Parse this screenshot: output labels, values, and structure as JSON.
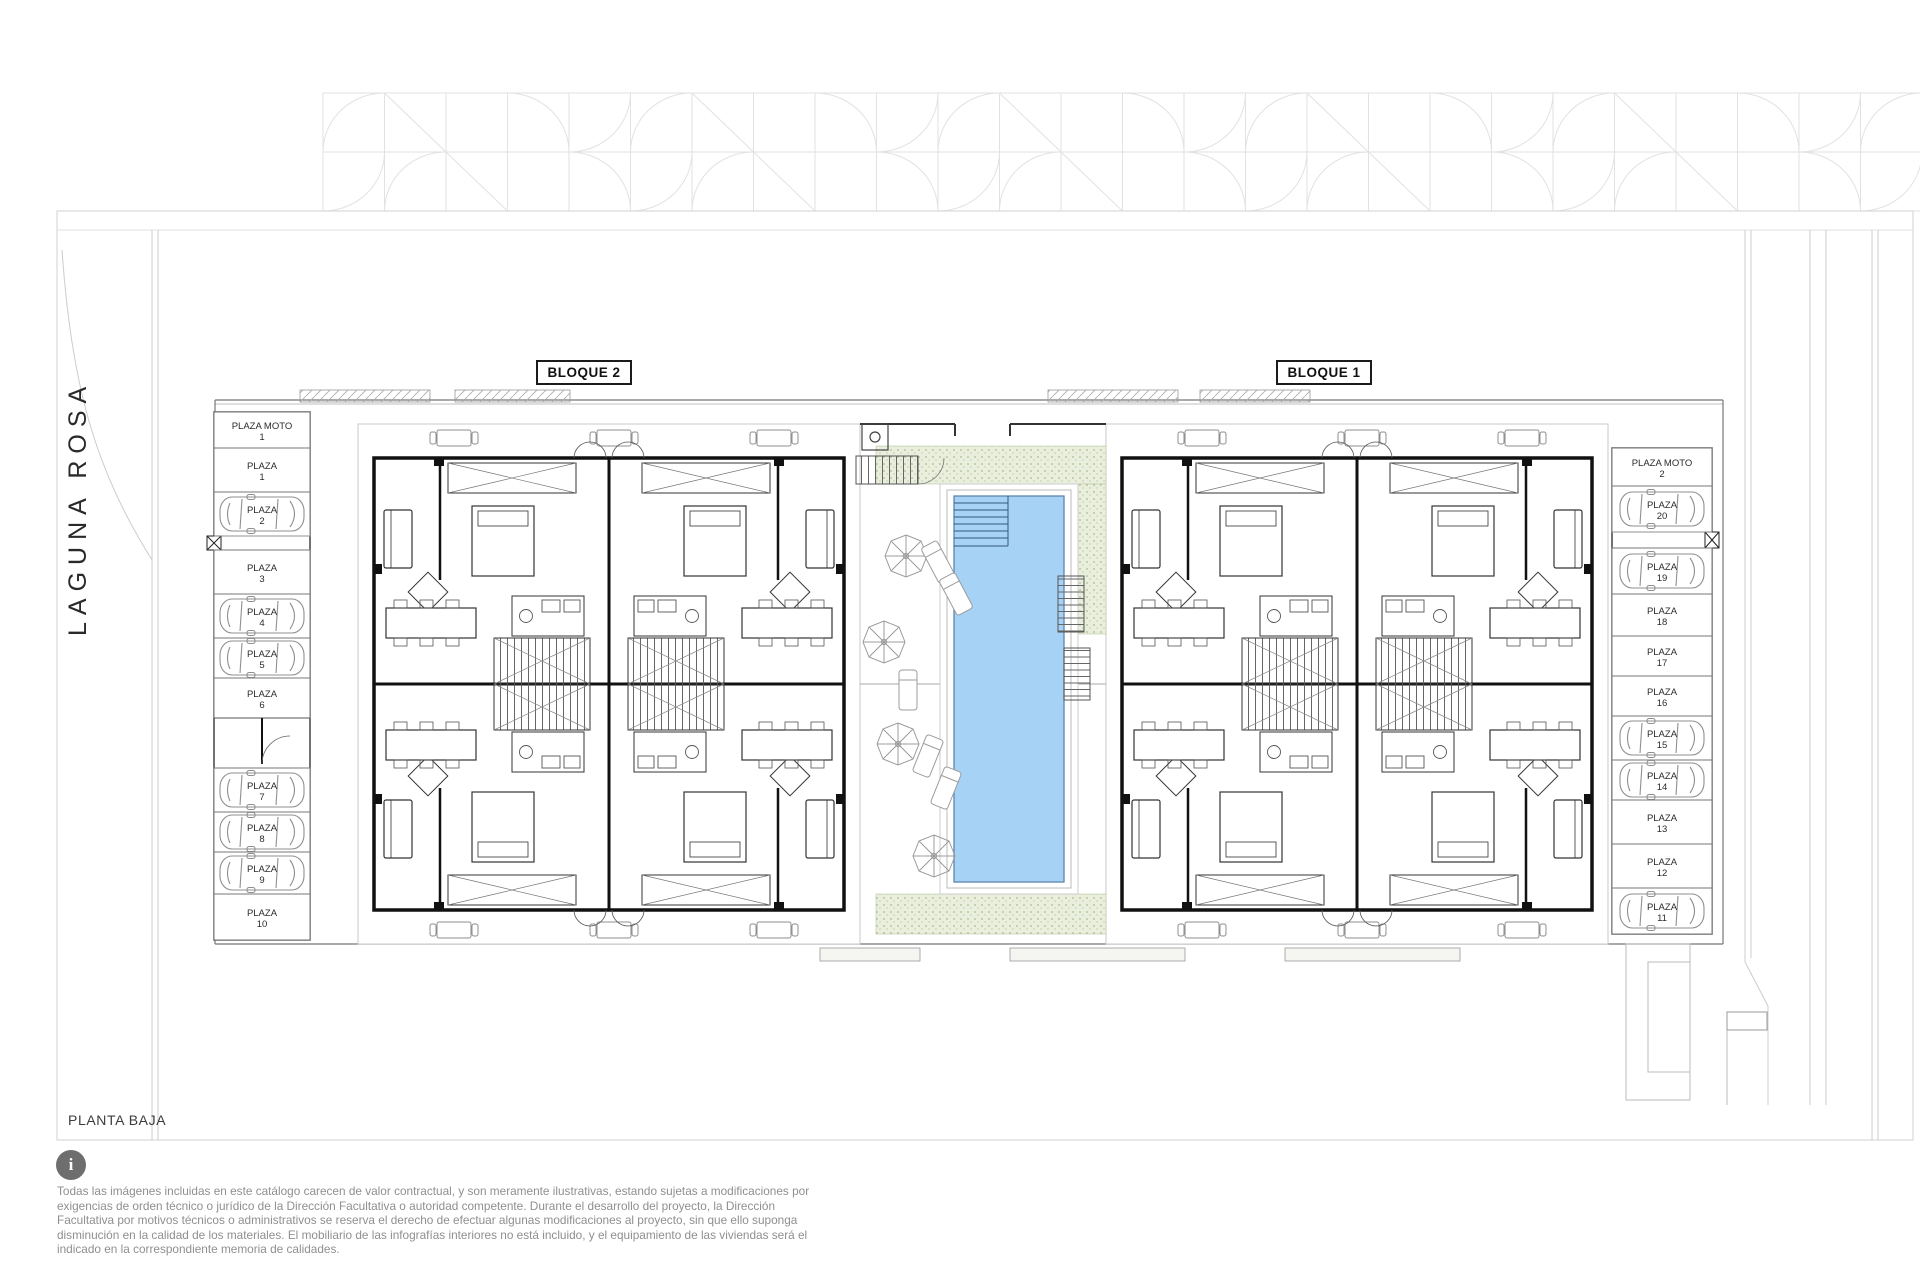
{
  "plan": {
    "title": "PLANTA BAJA",
    "street": "LAGUNA ROSA",
    "blocks": [
      {
        "label": "BLOQUE 2"
      },
      {
        "label": "BLOQUE 1"
      }
    ]
  },
  "parking": {
    "left": [
      {
        "name": "PLAZA MOTO",
        "number": "1",
        "occupied": false
      },
      {
        "name": "PLAZA",
        "number": "1",
        "occupied": false
      },
      {
        "name": "PLAZA",
        "number": "2",
        "occupied": true
      },
      {
        "name": "PLAZA",
        "number": "3",
        "occupied": false
      },
      {
        "name": "PLAZA",
        "number": "4",
        "occupied": true
      },
      {
        "name": "PLAZA",
        "number": "5",
        "occupied": true
      },
      {
        "name": "PLAZA",
        "number": "6",
        "occupied": false
      },
      {
        "name": "PLAZA",
        "number": "7",
        "occupied": true
      },
      {
        "name": "PLAZA",
        "number": "8",
        "occupied": true
      },
      {
        "name": "PLAZA",
        "number": "9",
        "occupied": true
      },
      {
        "name": "PLAZA",
        "number": "10",
        "occupied": false
      }
    ],
    "right": [
      {
        "name": "PLAZA MOTO",
        "number": "2",
        "occupied": false
      },
      {
        "name": "PLAZA",
        "number": "20",
        "occupied": true
      },
      {
        "name": "PLAZA",
        "number": "19",
        "occupied": true
      },
      {
        "name": "PLAZA",
        "number": "18",
        "occupied": false
      },
      {
        "name": "PLAZA",
        "number": "17",
        "occupied": false
      },
      {
        "name": "PLAZA",
        "number": "16",
        "occupied": false
      },
      {
        "name": "PLAZA",
        "number": "15",
        "occupied": true
      },
      {
        "name": "PLAZA",
        "number": "14",
        "occupied": true
      },
      {
        "name": "PLAZA",
        "number": "13",
        "occupied": false
      },
      {
        "name": "PLAZA",
        "number": "12",
        "occupied": false
      },
      {
        "name": "PLAZA",
        "number": "11",
        "occupied": true
      }
    ]
  },
  "footer": {
    "disclaimer": "Todas las imágenes incluidas en este catálogo carecen de valor contractual, y son meramente ilustrativas, estando sujetas a modificaciones por exigencias de orden técnico o jurídico de la Dirección Facultativa o autoridad competente. Durante el desarrollo del proyecto, la Dirección Facultativa por motivos técnicos o administrativos se reserva el derecho de efectuar algunas modificaciones al proyecto, sin que ello suponga disminución en la calidad de los materiales. El mobiliario de las infografías interiores no está incluido, y el equipamiento de las viviendas será el indicado en la correspondiente memoria de calidades."
  },
  "colors": {
    "pool_water": "#A6D2F6",
    "pool_edge": "#5E86AE",
    "deck_green": "#E9EFDC",
    "info_icon_gray": "#6E6E6E"
  }
}
